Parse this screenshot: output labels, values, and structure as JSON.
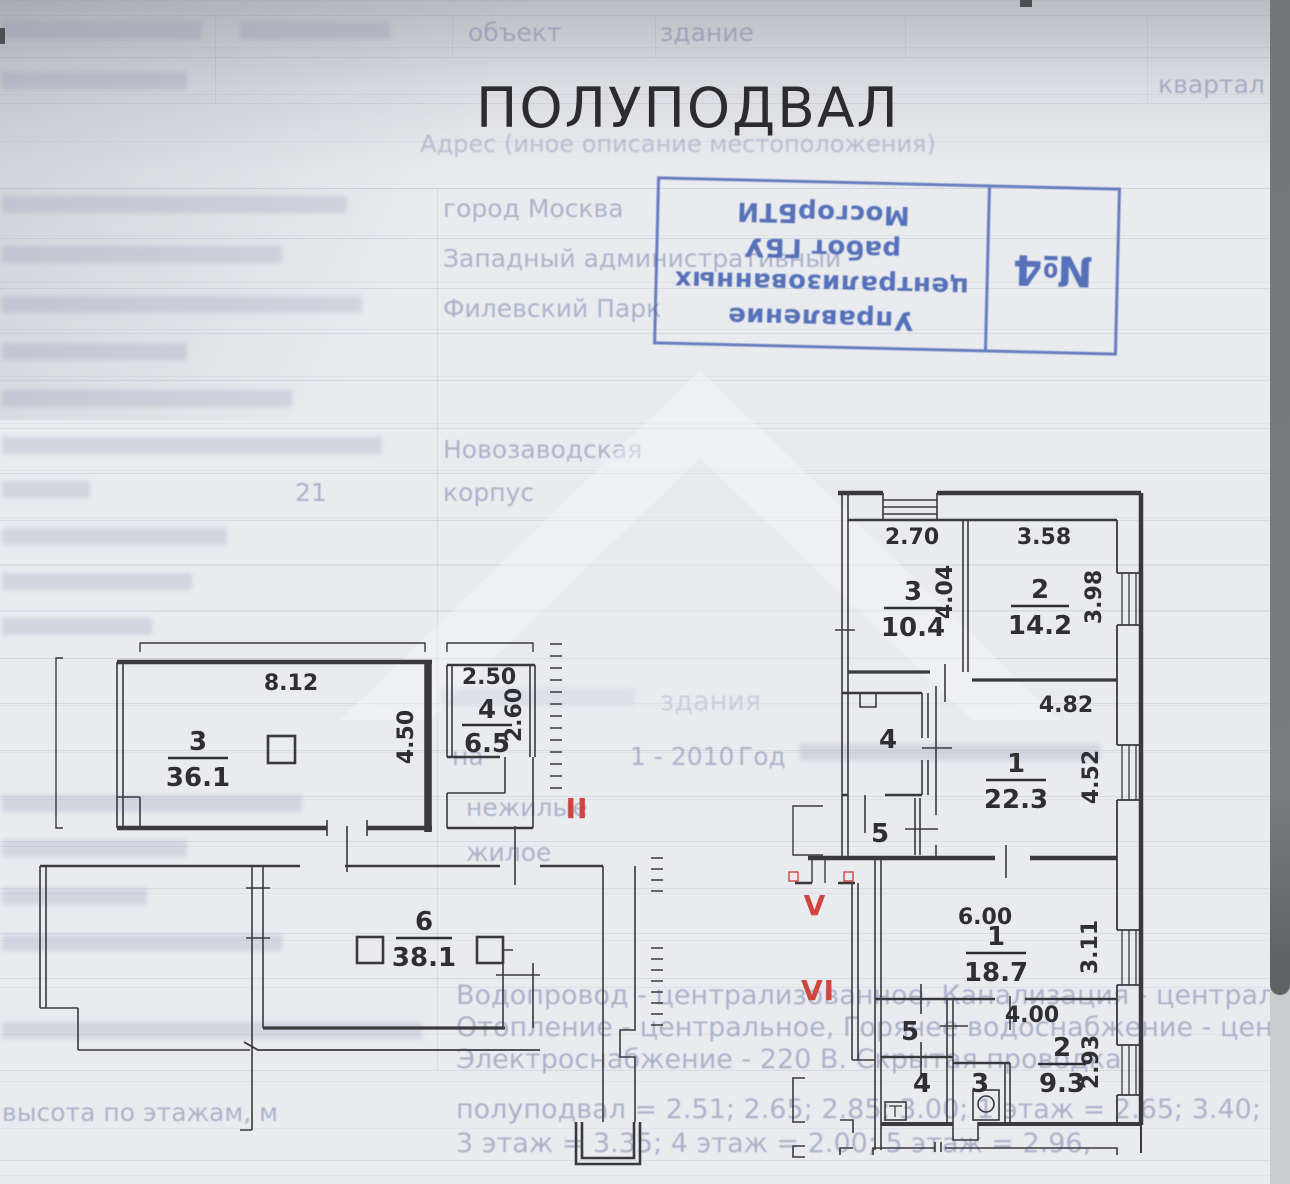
{
  "page": {
    "title": "ПОЛУПОДВАЛ",
    "address_caption": "Адрес (иное описание местоположения)"
  },
  "stamp": {
    "org_line1": "Управление",
    "org_line2": "централизованных",
    "org_line3": "работ ГБУ МосгорБТИ",
    "number": "№4",
    "color": "#4a67b4"
  },
  "form": {
    "top_object_label": "объект",
    "top_object_value": "здание",
    "kvartal_label": "квартал №",
    "values": {
      "city": "город Москва",
      "okrug": "Западный административный",
      "district": "Филевский Парк",
      "street": "Новозаводская",
      "house_num": "21",
      "korpus_label": "корпус",
      "na_label": "на",
      "year_row": "1 - 2010",
      "year_label": "Год",
      "nezhilye": "нежилые",
      "zhiloe": "жилое",
      "zdaniya": "здания"
    },
    "utilities_line1": "Водопровод - централизованное, Канализация - централизованное,",
    "utilities_line2": "Отопление - центральное, Горячее водоснабжение - централизованное,",
    "utilities_line3": "Электроснабжение - 220 В. Скрытая проводка",
    "heights_line1": "полуподвал = 2.51; 2.65; 2.85; 3.00;    1 этаж = 2.65; 3.40;    2 этаж",
    "heights_line2": "3 этаж = 3.35;    4 этаж = 2.00;    5 этаж = 2.96,",
    "height_label": "высота по этажам, м"
  },
  "plan": {
    "sections": {
      "s2": "II",
      "s5": "V",
      "s6": "VI"
    },
    "rooms": {
      "r36": {
        "num": "3",
        "area": "36.1"
      },
      "r65": {
        "num": "4",
        "area": "6.5"
      },
      "r381": {
        "num": "6",
        "area": "38.1"
      },
      "r104": {
        "num": "3",
        "area": "10.4"
      },
      "r142": {
        "num": "2",
        "area": "14.2"
      },
      "r223": {
        "num": "1",
        "area": "22.3"
      },
      "r187": {
        "num": "1",
        "area": "18.7"
      },
      "r93": {
        "num": "2",
        "area": "9.3"
      }
    },
    "small": {
      "u4": "4",
      "u5": "5",
      "l5": "5",
      "l4": "4",
      "l3": "3"
    },
    "dims": {
      "d812": "8.12",
      "d450": "4.50",
      "d250": "2.50",
      "d260": "2.60",
      "d270": "2.70",
      "d404": "4.04",
      "d358": "3.58",
      "d398": "3.98",
      "d482": "4.82",
      "d452": "4.52",
      "d600": "6.00",
      "d311": "3.11",
      "d400": "4.00",
      "d293": "2.93"
    },
    "colors": {
      "red": "#cf4640",
      "ink": "#3a3a3e"
    }
  }
}
